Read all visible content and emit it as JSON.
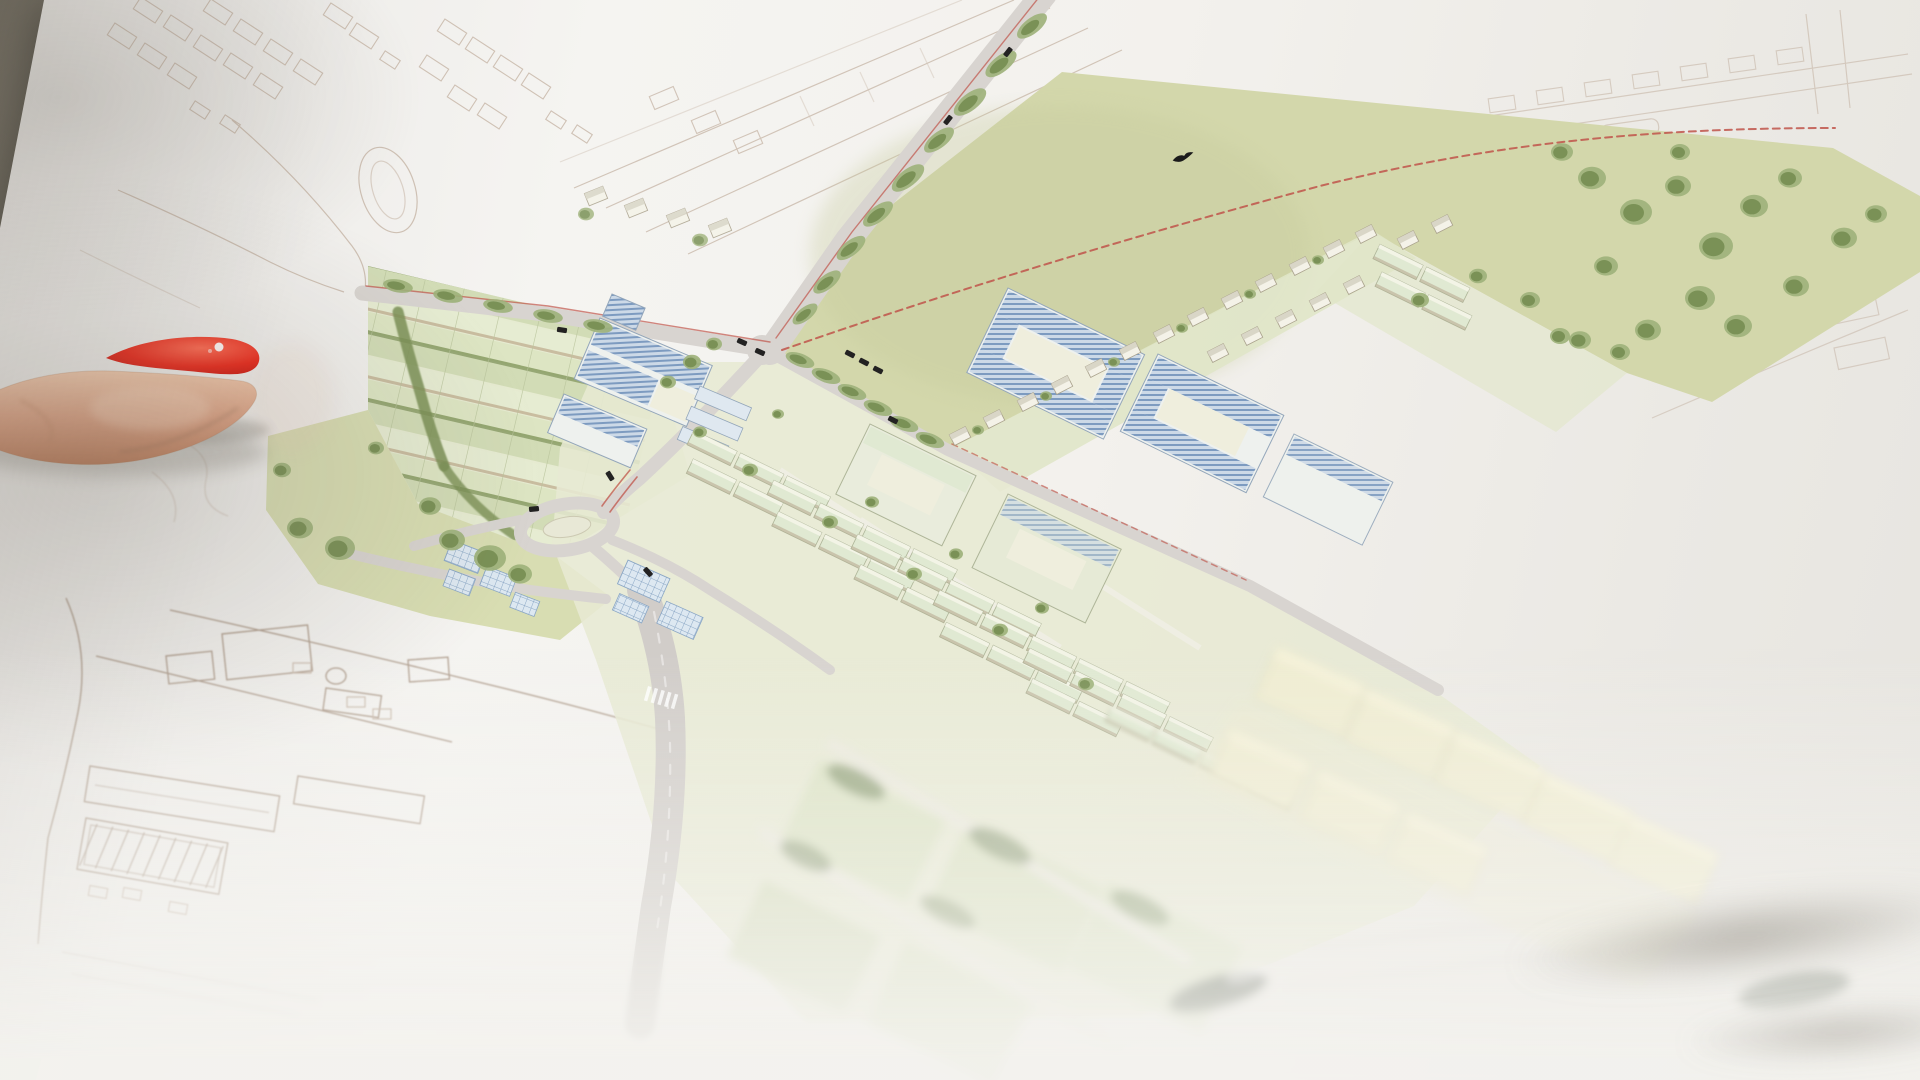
{
  "scene": {
    "type": "photograph",
    "description": "Close-up video still of a printed urban-development masterplan on a large sheet of white paper. A finger with a bright red polished nail points at the plan from the left edge. The upper map area is in sharp focus; the bottom of the photo falls out of focus and washes out. Dark table surface shows at the top-left corner behind the tilted paper.",
    "focus": "sharp on upper map, strong blur toward bottom edge",
    "visible_elements": [
      "white paper sheet",
      "pointing finger with red nail",
      "table surface corner",
      "watercolor masterplan drawing",
      "faint pencil sketch of surrounding city",
      "large green field with red dashed boundary",
      "tree-lined avenue",
      "roundabout",
      "allotment garden strips",
      "meadow with trees",
      "blue solar-roof buildings",
      "courtyard housing blocks",
      "rows of terraced houses",
      "detached houses along field edge",
      "cream industrial halls (blurred)",
      "park strip with scattered trees",
      "tiny black cars",
      "small black bird over the field",
      "two dark blurred marks near bottom edge"
    ]
  },
  "map": {
    "style": "watercolor axonometric masterplan on white paper",
    "features": {
      "development_field": "large pale olive-green open field in the upper center-right",
      "site_boundary": "thin red dashed line curving across the field",
      "main_avenue": "grey avenue with red traffic lines and a row of street trees along the field edge",
      "crossroads": "road junction with small black cars",
      "roundabout": "oval roundabout with pale green centre island",
      "allotments": "striped garden plots separated by dark hedgerows",
      "meadow": "green meadow with clustered trees left of the roundabout",
      "campus": "large buildings with blue hatched solar roofs near the avenue",
      "greenhouses": "small glass-grid roofed buildings south of the roundabout",
      "courtyard_blocks": "big perimeter blocks with blue solar-panel roofs and inner courtyards",
      "housing_rows": "many rows of small pale-green-roofed terraces",
      "edge_houses": "line of little detached houses bordering the field",
      "industrial_halls": "row of cream flat boxes lower right, out of focus",
      "park": "tree-dotted green strip on the right side",
      "context_sketch": "existing city around the plan drawn only as faint brown line work",
      "bird": "tiny black bird silhouette flying over the field",
      "dark_marks": "two dark green blurred marks (stamps/logos) near the blurred bottom edge"
    }
  },
  "hand": {
    "part": "index finger entering from the left",
    "nail_polish": "bright red",
    "nail_highlight": "small white shine dot on the nail tip",
    "shadow": "soft shadow cast on the paper under the fingertip"
  },
  "colors": {
    "bg": "#847f72",
    "bgDark": "#6c675b",
    "paper": "#f1efec",
    "field": "#d3d7ab",
    "fieldShade": "#c6ca9c",
    "meadow": "#d8ddb2",
    "allot": "#e6ebd1",
    "stripA": "#dde5c3",
    "stripB": "#d2dcb6",
    "stripC": "#e6ecd2",
    "soil": "#c2b193",
    "hedge": "#7c9156",
    "tree": "#7a9156",
    "treeL": "#9eb27b",
    "road": "#d8d4d0",
    "roadS": "#d1cdc9",
    "island": "#e8e8d6",
    "red": "#c0544a",
    "hatchBg": "#ccd9e7",
    "hatchLn": "#7d9bc0",
    "gridBg": "#dde8f1",
    "gridLn": "#8ba7c5",
    "blueWall": "#eef1ee",
    "blueEdge": "#93a6ba",
    "roofPale": "#e0e9d2",
    "roofEdge": "#aeb598",
    "roofHi": "#f6f6ea",
    "roofSh": "#b9ab92",
    "wall": "#f4f2e8",
    "wallEdge": "#a9a18c",
    "hRoofC": "#d9d6c7",
    "cream": "#f0edd2",
    "creamHi": "#f7f4dc",
    "creamEdge": "#dbd5b0",
    "fabric": "#e7e9d3",
    "court": "#efeedd",
    "neGround": "#e4e7d0",
    "garden": "#e0e5c8",
    "sketch": "#c3b1a1",
    "sketchD": "#a5917f",
    "car": "#232222",
    "bird": "#1b1b1b",
    "nailRed": "#ea2a1c",
    "nailHi": "#ff6a52",
    "nailDeep": "#c11711",
    "shine": "#ffffff",
    "skinHi": "#f0c9ad",
    "skinMid": "#dba285",
    "skinLo": "#bd7f5e",
    "logo": "#3f4a3a",
    "shadow": "#6e695f"
  }
}
